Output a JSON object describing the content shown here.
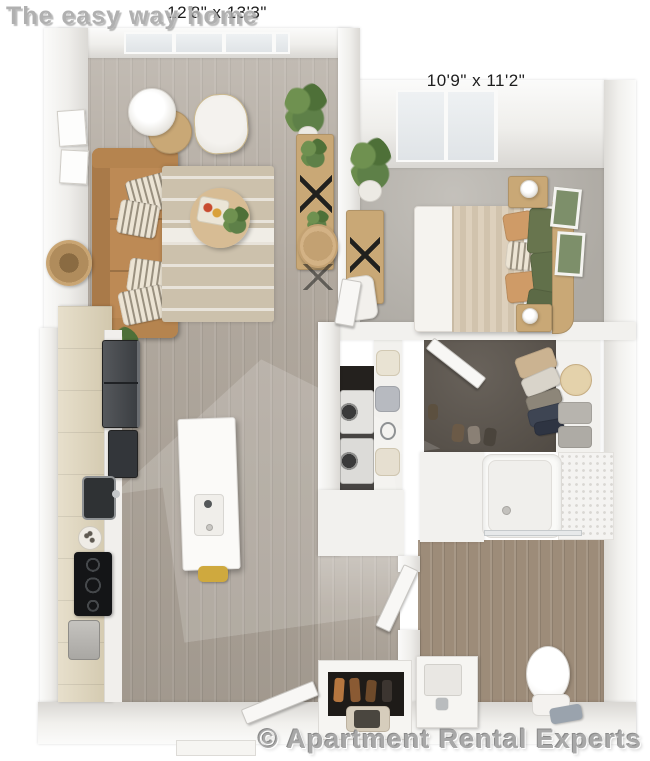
{
  "watermarks": {
    "brand_top": "The easy way home",
    "brand_bottom": "© Apartment Rental Experts"
  },
  "rooms": {
    "living_room": {
      "dimensions": "12'8\" x 13'3\""
    },
    "bedroom": {
      "dimensions": "10'9\" x 11'2\""
    }
  },
  "colors": {
    "wood_floor": "#aaa196",
    "bath_floor": "#9d8c79",
    "bedroom_carpet": "#b7b3ac",
    "closet_carpet": "#5c554d",
    "wall": "#f2f1ee",
    "wall_shade": "#d8d6d2",
    "sofa": "#bd8a55",
    "rug": "#ccc1ac",
    "wood_furniture": "#c9a876",
    "plant": "#5e8048",
    "pillow_green": "#68754e",
    "pillow_tan": "#cf9b67",
    "appliance_dark": "#33363a",
    "laundry_dark": "#24211e",
    "island_white": "#fbfaf8",
    "accent_yellow": "#cfa93e",
    "watermark_gray": "#a8a8a8"
  }
}
